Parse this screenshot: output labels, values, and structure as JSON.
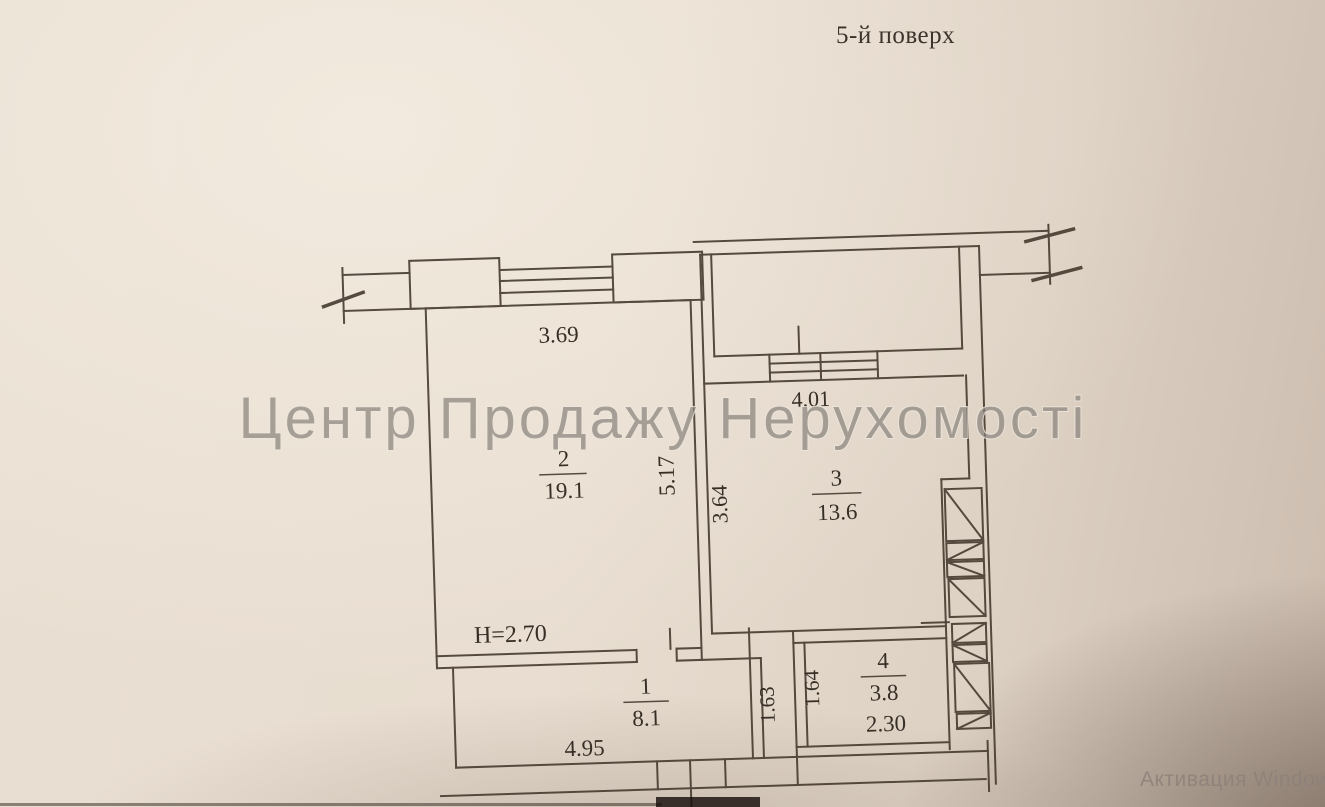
{
  "header": {
    "floor_title": "5-й поверх"
  },
  "watermarks": {
    "agency": "Центр Продажу Нерухомості",
    "windows_activation": "Активация Windows"
  },
  "plan": {
    "ceiling_height": "H=2.70",
    "rooms": [
      {
        "number": "1",
        "area": "8.1"
      },
      {
        "number": "2",
        "area": "19.1"
      },
      {
        "number": "3",
        "area": "13.6"
      },
      {
        "number": "4",
        "area": "3.8"
      }
    ],
    "dimensions": {
      "room2_width": "3.69",
      "room2_depth": "5.17",
      "room3_depth": "3.64",
      "room3_loggia_width": "4.01",
      "hall_length": "4.95",
      "niche_depth_left": "1.63",
      "niche_depth_right": "1.64",
      "room4_width": "2.30"
    }
  }
}
